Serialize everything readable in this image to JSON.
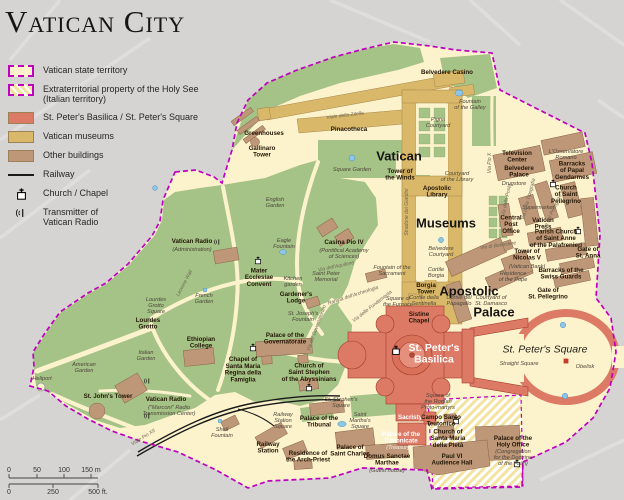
{
  "title": "Vatican City",
  "colors": {
    "background": "#d6d4d2",
    "territory_fill": "#fcf3cd",
    "boundary_magenta": "#bf00bf",
    "garden_green": "#a5c287",
    "basilica_red": "#dd7a66",
    "museums_tan": "#d9b969",
    "buildings_brown": "#bd9778",
    "water_blue": "#8ec6e6",
    "railway_black": "#1a1a1a"
  },
  "legend": {
    "items": [
      {
        "swatch": "territory",
        "label": "Vatican state territory"
      },
      {
        "swatch": "extraterritorial",
        "label": "Extraterritorial property of the Holy See\n(Italian territory)"
      },
      {
        "swatch": "solid",
        "color_key": "basilica_red",
        "label": "St. Peter's Basilica / St. Peter's Square"
      },
      {
        "swatch": "solid",
        "color_key": "museums_tan",
        "label": "Vatican museums"
      },
      {
        "swatch": "solid",
        "color_key": "buildings_brown",
        "label": "Other buildings"
      },
      {
        "swatch": "railway",
        "label": "Railway"
      },
      {
        "swatch": "church",
        "label": "Church / Chapel"
      },
      {
        "swatch": "transmitter",
        "label": "Transmitter of\nVatican Radio"
      }
    ]
  },
  "scale_bar": {
    "meters": [
      "0",
      "50",
      "100",
      "150 m"
    ],
    "feet": [
      "0",
      "250",
      "500 ft."
    ]
  },
  "map": {
    "labels": [
      {
        "t": "Vatican",
        "x": 399,
        "y": 156,
        "c": "big"
      },
      {
        "t": "Museums",
        "x": 446,
        "y": 223,
        "c": "big"
      },
      {
        "t": "Apostolic",
        "x": 469,
        "y": 291,
        "c": "big"
      },
      {
        "t": "Palace",
        "x": 494,
        "y": 312,
        "c": "big"
      },
      {
        "t": "St. Peter's\nBasilica",
        "x": 434,
        "y": 353,
        "c": "bigwhite"
      },
      {
        "t": "St. Peter's Square",
        "x": 545,
        "y": 349,
        "c": "area"
      },
      {
        "t": "Greenhouses",
        "x": 264,
        "y": 133,
        "c": "place"
      },
      {
        "t": "Gallinaro\nTower",
        "x": 262,
        "y": 151,
        "c": "place"
      },
      {
        "t": "Pinacotheca",
        "x": 349,
        "y": 129,
        "c": "place"
      },
      {
        "t": "Viale della Zitella",
        "x": 345,
        "y": 115,
        "c": "street",
        "r": -7
      },
      {
        "t": "Square Garden",
        "x": 352,
        "y": 169,
        "c": "minor"
      },
      {
        "t": "Tower of\nthe Winds",
        "x": 400,
        "y": 174,
        "c": "place"
      },
      {
        "t": "Belvedere Casino",
        "x": 447,
        "y": 72,
        "c": "place"
      },
      {
        "t": "Fountain\nof the Galley",
        "x": 470,
        "y": 104,
        "c": "minor"
      },
      {
        "t": "Pigna\nCourtyard",
        "x": 438,
        "y": 122,
        "c": "minor"
      },
      {
        "t": "Courtyard\nof the Library",
        "x": 457,
        "y": 176,
        "c": "minor"
      },
      {
        "t": "Apostolic\nLibrary",
        "x": 437,
        "y": 191,
        "c": "place"
      },
      {
        "t": "Belvedere\nCourtyard",
        "x": 441,
        "y": 251,
        "c": "minor"
      },
      {
        "t": "Cortile\nBorgia",
        "x": 436,
        "y": 272,
        "c": "minor"
      },
      {
        "t": "Borgia\nTower",
        "x": 426,
        "y": 288,
        "c": "place"
      },
      {
        "t": "Sistine\nChapel",
        "x": 419,
        "y": 317,
        "c": "place"
      },
      {
        "t": "Cortile della\nSentinella",
        "x": 424,
        "y": 300,
        "c": "minor"
      },
      {
        "t": "Cortile del\nPapagallo",
        "x": 459,
        "y": 300,
        "c": "minor"
      },
      {
        "t": "Courtyard of\nSt. Damasco",
        "x": 491,
        "y": 300,
        "c": "minor"
      },
      {
        "t": "Television\nCenter",
        "x": 517,
        "y": 156,
        "c": "place"
      },
      {
        "t": "L'Osservatore\nRomano",
        "x": 566,
        "y": 154,
        "c": "minor"
      },
      {
        "t": "Belvedere\nPalace",
        "x": 519,
        "y": 171,
        "c": "place"
      },
      {
        "t": "Drugstore",
        "x": 514,
        "y": 183,
        "c": "minor"
      },
      {
        "t": "Barracks\nof Papal\nGendarmes",
        "x": 572,
        "y": 170,
        "c": "place"
      },
      {
        "t": "Church\nof Saint\nPellegrino",
        "x": 566,
        "y": 194,
        "c": "place"
      },
      {
        "t": "Supermarket",
        "x": 538,
        "y": 207,
        "c": "minor"
      },
      {
        "t": "Central\nPost\nOffice",
        "x": 511,
        "y": 224,
        "c": "place"
      },
      {
        "t": "Vatican\nPress",
        "x": 543,
        "y": 223,
        "c": "place"
      },
      {
        "t": "Parish Church\nof Saint Anne\nof the Palafrenieri",
        "x": 556,
        "y": 238,
        "c": "place"
      },
      {
        "t": "Gate of\nSt. Anna",
        "x": 588,
        "y": 252,
        "c": "place"
      },
      {
        "t": "Tower of\nNicolas V",
        "x": 527,
        "y": 254,
        "c": "place"
      },
      {
        "t": "(Vatican Bank)",
        "x": 527,
        "y": 266,
        "c": "minor"
      },
      {
        "t": "Residence\nof the Pope",
        "x": 513,
        "y": 276,
        "c": "minor"
      },
      {
        "t": "Barracks of the\nSwiss Guards",
        "x": 561,
        "y": 273,
        "c": "place"
      },
      {
        "t": "Gate of\nSt. Pellegrino",
        "x": 548,
        "y": 293,
        "c": "place"
      },
      {
        "t": "Via Pio X",
        "x": 489,
        "y": 163,
        "c": "street",
        "r": -90
      },
      {
        "t": "Via della Posta",
        "x": 506,
        "y": 200,
        "c": "street",
        "r": -78
      },
      {
        "t": "Via della Tipografia",
        "x": 528,
        "y": 199,
        "c": "street",
        "r": -75
      },
      {
        "t": "Via del Pellegrino",
        "x": 552,
        "y": 212,
        "c": "street",
        "r": -65
      },
      {
        "t": "Via di Belvedere",
        "x": 498,
        "y": 245,
        "c": "street",
        "r": -8
      },
      {
        "t": "Stradone dei Giardini",
        "x": 406,
        "y": 212,
        "c": "street",
        "r": -90
      },
      {
        "t": "English\nGarden",
        "x": 275,
        "y": 202,
        "c": "minor"
      },
      {
        "t": "Casina Pio IV",
        "x": 344,
        "y": 242,
        "c": "place"
      },
      {
        "t": "(Pontifical Academy\nof Sciences)",
        "x": 344,
        "y": 253,
        "c": "minor"
      },
      {
        "t": "Fountain of the\nSacrament",
        "x": 392,
        "y": 270,
        "c": "minor"
      },
      {
        "t": "Saint Peter\nMemorial",
        "x": 326,
        "y": 276,
        "c": "minor"
      },
      {
        "t": "Via dell'Aquilone",
        "x": 336,
        "y": 266,
        "c": "street",
        "r": -12
      },
      {
        "t": "Rampa dell'Archeologia",
        "x": 353,
        "y": 295,
        "c": "street",
        "r": -18
      },
      {
        "t": "Via delle Fondamenta",
        "x": 372,
        "y": 306,
        "c": "street",
        "r": -38
      },
      {
        "t": "Via del Governatorato",
        "x": 316,
        "y": 328,
        "c": "street",
        "r": -70
      },
      {
        "t": "Leonine Wall",
        "x": 184,
        "y": 283,
        "c": "street",
        "r": -62
      },
      {
        "t": "Vatican Radio",
        "x": 192,
        "y": 241,
        "c": "place"
      },
      {
        "t": "(Administration)",
        "x": 192,
        "y": 249,
        "c": "minor"
      },
      {
        "t": "Mater\nEcclesiae\nConvent",
        "x": 259,
        "y": 277,
        "c": "place"
      },
      {
        "t": "Kitchen\ngarden",
        "x": 293,
        "y": 281,
        "c": "minor"
      },
      {
        "t": "Eagle\nFountain",
        "x": 284,
        "y": 243,
        "c": "minor"
      },
      {
        "t": "French\nGarden",
        "x": 204,
        "y": 298,
        "c": "minor"
      },
      {
        "t": "Lourdes\nGrotto\nSquare",
        "x": 156,
        "y": 305,
        "c": "minor"
      },
      {
        "t": "Lourdes\nGrotto",
        "x": 148,
        "y": 323,
        "c": "place"
      },
      {
        "t": "Ethiopian\nCollege",
        "x": 201,
        "y": 342,
        "c": "place"
      },
      {
        "t": "Italian\nGarden",
        "x": 146,
        "y": 355,
        "c": "minor"
      },
      {
        "t": "American\nGarden",
        "x": 84,
        "y": 367,
        "c": "minor"
      },
      {
        "t": "Heliport",
        "x": 42,
        "y": 378,
        "c": "minor"
      },
      {
        "t": "St. John's Tower",
        "x": 108,
        "y": 396,
        "c": "place"
      },
      {
        "t": "Vatican Radio",
        "x": 166,
        "y": 399,
        "c": "place"
      },
      {
        "t": "(\"Marconi\" Radio\nTransmission Center)",
        "x": 169,
        "y": 410,
        "c": "minor"
      },
      {
        "t": "Chapel of\nSanta Maria\nRegina della\nFamiglia",
        "x": 243,
        "y": 369,
        "c": "place"
      },
      {
        "t": "Gardener's\nLodge",
        "x": 296,
        "y": 297,
        "c": "place"
      },
      {
        "t": "St. Joseph's\nFountain",
        "x": 303,
        "y": 316,
        "c": "minor"
      },
      {
        "t": "Palace of the\nGovernatorate",
        "x": 285,
        "y": 338,
        "c": "place"
      },
      {
        "t": "Church of\nSaint Stephen\nof the Abyssinians",
        "x": 309,
        "y": 372,
        "c": "place"
      },
      {
        "t": "St. Stephen's\nSquare",
        "x": 341,
        "y": 402,
        "c": "minor"
      },
      {
        "t": "Shell\nFountain",
        "x": 222,
        "y": 432,
        "c": "minor"
      },
      {
        "t": "Railway\nStation\nSquare",
        "x": 283,
        "y": 420,
        "c": "minor"
      },
      {
        "t": "Railway\nStation",
        "x": 268,
        "y": 447,
        "c": "place"
      },
      {
        "t": "Palace of the\nTribunal",
        "x": 319,
        "y": 421,
        "c": "place"
      },
      {
        "t": "Saint\nMartha's\nSquare",
        "x": 360,
        "y": 420,
        "c": "minor"
      },
      {
        "t": "Residence of\nthe Arch-Priest",
        "x": 308,
        "y": 456,
        "c": "place"
      },
      {
        "t": "Palace of\nSaint Charles",
        "x": 350,
        "y": 450,
        "c": "place"
      },
      {
        "t": "Domus Sanctae\nMarthae",
        "x": 387,
        "y": 459,
        "c": "place"
      },
      {
        "t": "(Guest house)",
        "x": 387,
        "y": 470,
        "c": "minor"
      },
      {
        "t": "Sacristy",
        "x": 410,
        "y": 417,
        "c": "placewhite"
      },
      {
        "t": "Palace of the\nCanonicate",
        "x": 401,
        "y": 437,
        "c": "placewhite"
      },
      {
        "t": "(Treasury)",
        "x": 399,
        "y": 447,
        "c": "minorwhite"
      },
      {
        "t": "Square of\nthe Roman\nProto-martyrs",
        "x": 438,
        "y": 401,
        "c": "minor"
      },
      {
        "t": "Square of\nthe Furnace",
        "x": 398,
        "y": 301,
        "c": "minor"
      },
      {
        "t": "Campo Santo\nTeutonico",
        "x": 441,
        "y": 420,
        "c": "place"
      },
      {
        "t": "Church of\nSanta Maria\ndella Pietà",
        "x": 448,
        "y": 438,
        "c": "place"
      },
      {
        "t": "Paul VI\nAudience Hall",
        "x": 452,
        "y": 459,
        "c": "place"
      },
      {
        "t": "Palace of the\nHoly Office",
        "x": 513,
        "y": 441,
        "c": "place"
      },
      {
        "t": "(Congregation\nfor the Doctrine\nof the Faith)",
        "x": 513,
        "y": 457,
        "c": "minor"
      },
      {
        "t": "Straight Square",
        "x": 519,
        "y": 363,
        "c": "minor"
      },
      {
        "t": "Obelisk",
        "x": 585,
        "y": 366,
        "c": "minor"
      },
      {
        "t": "Viale Pio XII",
        "x": 143,
        "y": 437,
        "c": "street",
        "r": -32
      }
    ],
    "icons": [
      {
        "type": "church",
        "x": 396,
        "y": 351,
        "s": 1.25
      },
      {
        "type": "church",
        "x": 553,
        "y": 184
      },
      {
        "type": "church",
        "x": 578,
        "y": 231
      },
      {
        "type": "church",
        "x": 258,
        "y": 261
      },
      {
        "type": "church",
        "x": 253,
        "y": 348
      },
      {
        "type": "church",
        "x": 309,
        "y": 388
      },
      {
        "type": "church",
        "x": 456,
        "y": 421
      },
      {
        "type": "church",
        "x": 517,
        "y": 464
      },
      {
        "type": "antenna",
        "x": 218,
        "y": 242
      },
      {
        "type": "antenna",
        "x": 148,
        "y": 381
      },
      {
        "type": "antenna",
        "x": 148,
        "y": 416
      },
      {
        "type": "obelisk",
        "x": 566,
        "y": 361
      }
    ],
    "fountains": [
      {
        "x": 155,
        "y": 188,
        "r": 2.4
      },
      {
        "x": 352,
        "y": 158,
        "r": 3.0
      },
      {
        "x": 459,
        "y": 93,
        "rx": 4,
        "ry": 3
      },
      {
        "x": 441,
        "y": 240,
        "r": 2.6
      },
      {
        "x": 283,
        "y": 252,
        "rx": 3.4,
        "ry": 2.4
      },
      {
        "x": 205,
        "y": 290,
        "r": 2.0
      },
      {
        "x": 342,
        "y": 424,
        "rx": 4.2,
        "ry": 2.6
      },
      {
        "x": 563,
        "y": 325,
        "r": 2.8
      },
      {
        "x": 565,
        "y": 396,
        "r": 2.8
      },
      {
        "x": 220,
        "y": 421,
        "r": 2.0
      }
    ]
  }
}
